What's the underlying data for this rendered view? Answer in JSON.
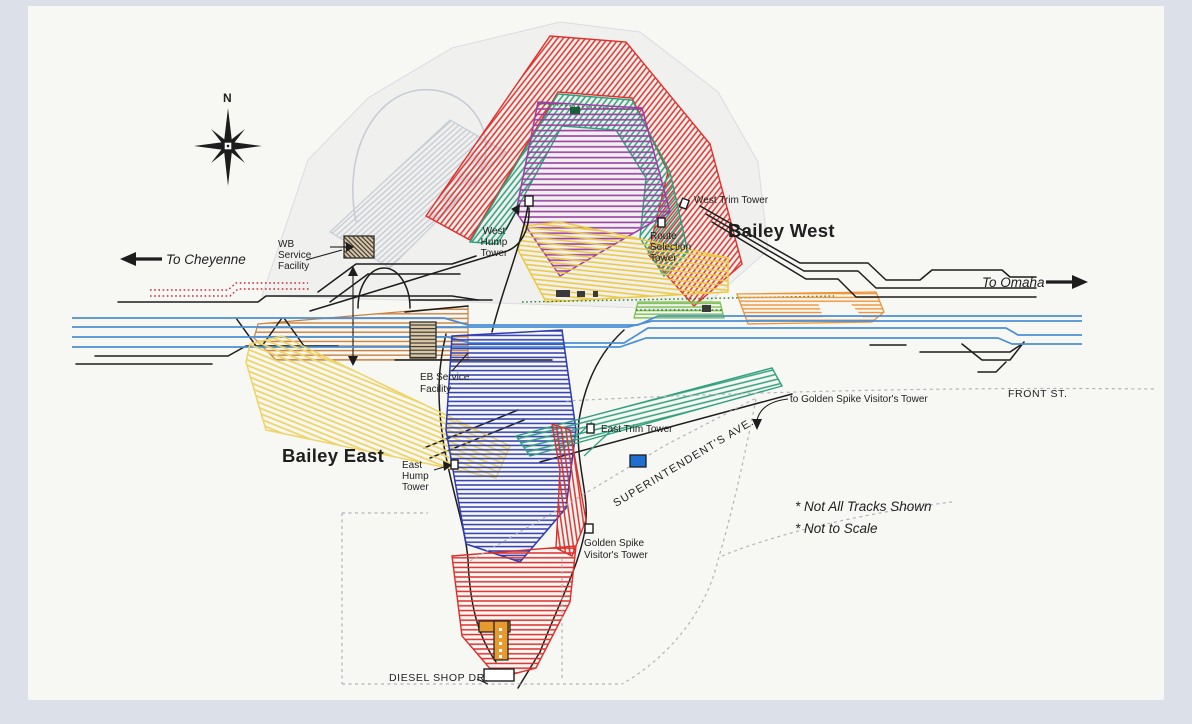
{
  "title": "Bailey Yard schematic track diagram",
  "colors": {
    "frame": "#dbe0e9",
    "paper": "#f7f7f4",
    "backdrop": "#f0f1ee",
    "line": "#1d1d1d",
    "red": "#e0302b",
    "teal": "#2f9f7d",
    "purple": "#9d3da5",
    "yellow_wb": "#edc943",
    "orange": "#ee9334",
    "green": "#7cc24f",
    "brown": "#c9803f",
    "yellow_eb": "#efd465",
    "blue_bowl": "#2e3cb2",
    "teal_dep": "#2fa07e",
    "red_fan": "#dd2f2a",
    "gray_fan": "#c7ccd5",
    "mainline": "#4a8fd6",
    "road": "#b0b5bc",
    "dotted_red": "#cc2936",
    "dotted_green": "#2f7d35",
    "building_blue": "#1e6fd0",
    "diesel_orange": "#e79a2e",
    "dark": "#3a3a3a",
    "tan": "#dcc9a4",
    "text": "#1f1f1f"
  },
  "compass": {
    "north": "N"
  },
  "directions": {
    "to_cheyenne": "To Cheyenne",
    "to_omaha": "To Omaha"
  },
  "areas": {
    "bailey_west": "Bailey West",
    "bailey_east": "Bailey East"
  },
  "towers": {
    "west_hump": [
      "West",
      "Hump",
      "Tower"
    ],
    "east_hump": [
      "East",
      "Hump",
      "Tower"
    ],
    "route_selection": [
      "Route",
      "Selection",
      "Tower"
    ],
    "west_trim": "West Trim Tower",
    "east_trim": "East Trim Tower",
    "golden_spike": [
      "Golden Spike",
      "Visitor's Tower"
    ],
    "golden_spike_leader": "to Golden Spike Visitor's Tower"
  },
  "facilities": {
    "wb_service": [
      "WB",
      "Service",
      "Facility"
    ],
    "eb_service": [
      "EB Service",
      "Facility"
    ]
  },
  "streets": {
    "front": "FRONT ST.",
    "superintendents": "SUPERINTENDENT'S AVE.",
    "diesel_shop": "DIESEL SHOP DR."
  },
  "notes": {
    "tracks": "* Not All Tracks Shown",
    "scale": "* Not to Scale"
  }
}
